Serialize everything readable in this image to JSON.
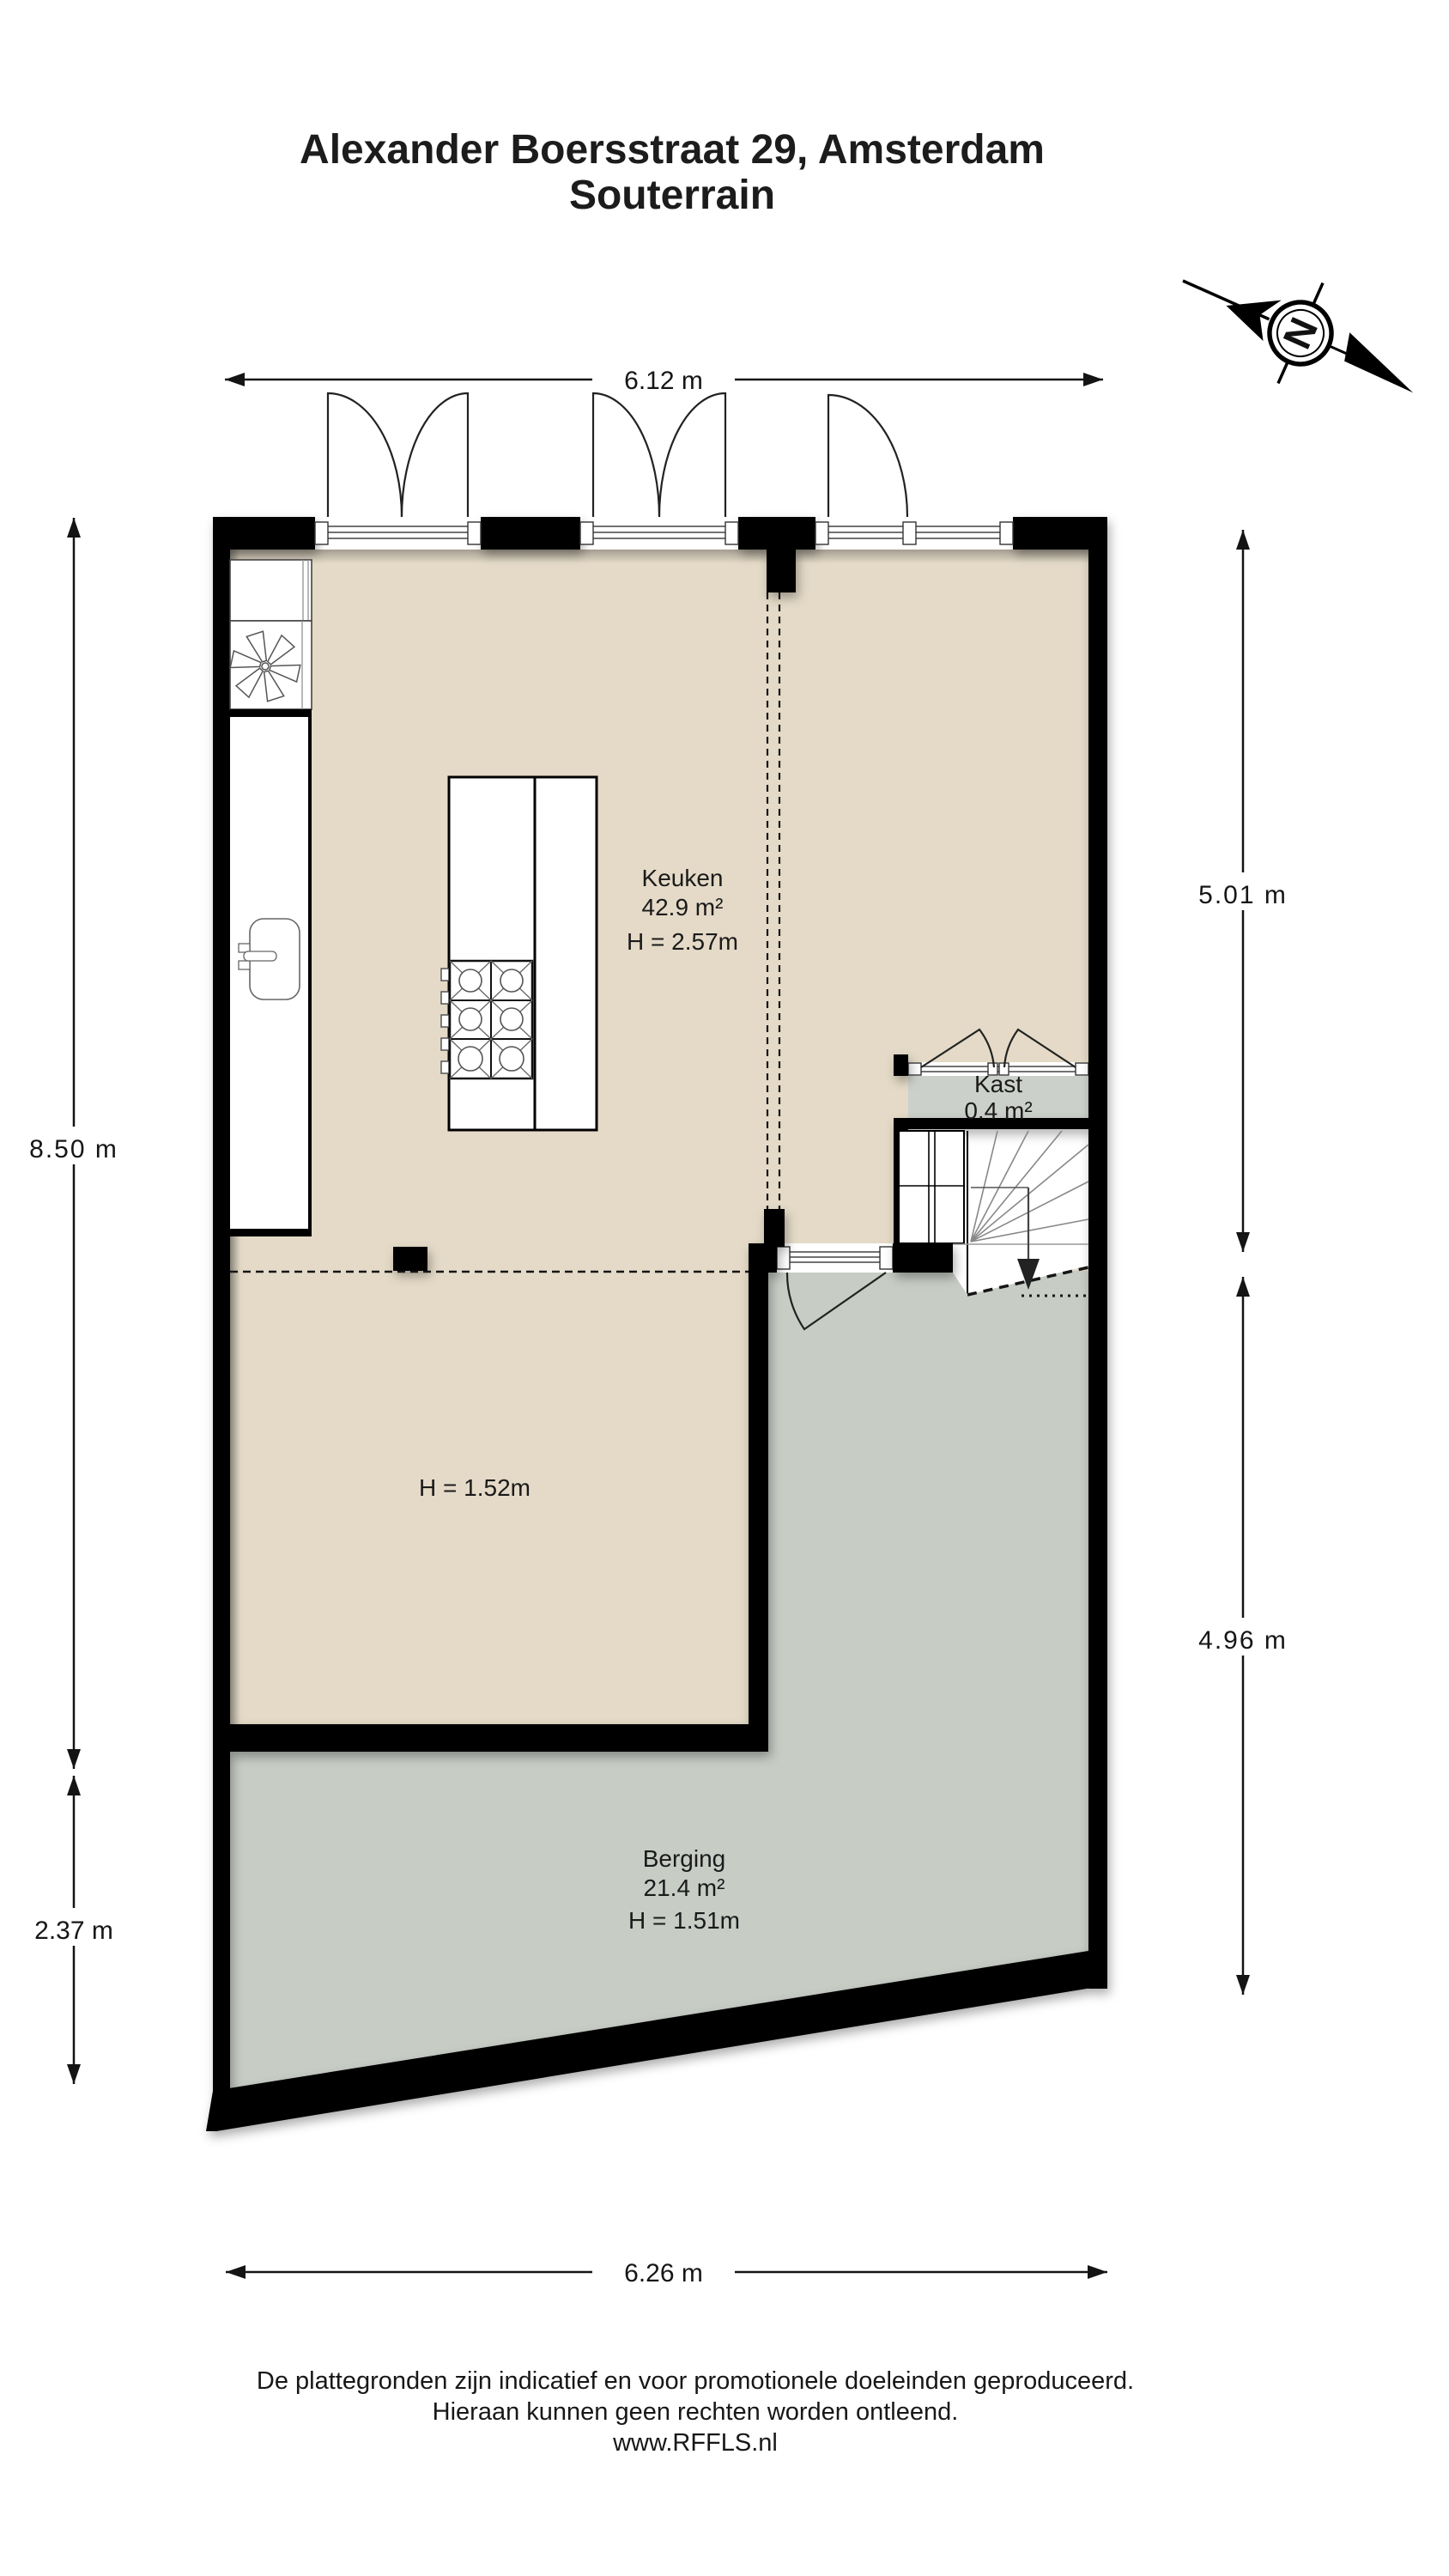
{
  "title": {
    "line1": "Alexander Boersstraat 29, Amsterdam",
    "line2": "Souterrain"
  },
  "compass": {
    "letter": "N"
  },
  "dimensions": {
    "top": "6.12 m",
    "bottom": "6.26 m",
    "left_upper": "8.50 m",
    "left_lower": "2.37 m",
    "right_upper": "5.01 m",
    "right_lower": "4.96 m"
  },
  "rooms": {
    "keuken": {
      "name": "Keuken",
      "area": "42.9 m²",
      "height": "H = 2.57m"
    },
    "kast": {
      "name": "Kast",
      "area": "0.4 m²"
    },
    "lower": {
      "height": "H = 1.52m"
    },
    "berging": {
      "name": "Berging",
      "area": "21.4 m²",
      "height": "H = 1.51m"
    }
  },
  "footer": {
    "line1": "De plattegronden zijn indicatief en voor promotionele doeleinden geproduceerd.",
    "line2": "Hieraan kunnen geen rechten worden ontleend.",
    "line3": "www.RFFLS.nl"
  },
  "icons": {
    "compass": "compass-north-icon",
    "fan": "extractor-fan-icon",
    "sink": "sink-icon",
    "stove": "stove-burners-icon",
    "stairs": "stairs-down-arrow-icon"
  },
  "colors": {
    "floor_beige": "#e4dac7",
    "floor_gray": "#c7ccc5",
    "kast_gray": "#ccd0ca",
    "wall_black": "#000000"
  }
}
